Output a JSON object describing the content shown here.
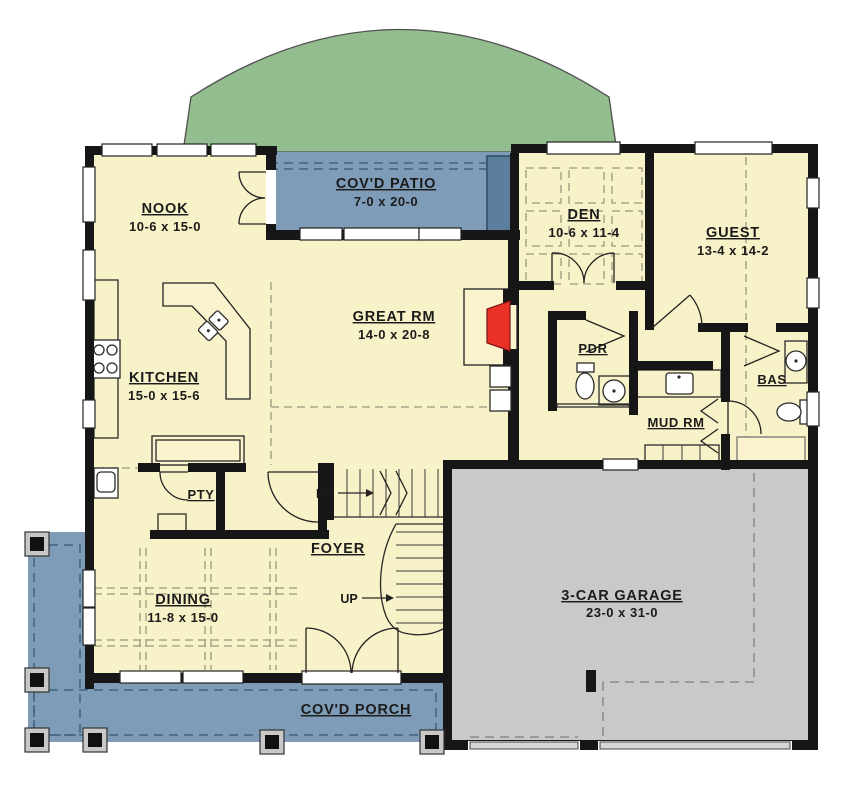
{
  "plan": {
    "rooms": {
      "nook": {
        "name": "NOOK",
        "dims": "10-6 x 15-0"
      },
      "patio": {
        "name": "COV'D PATIO",
        "dims": "7-0 x 20-0"
      },
      "den": {
        "name": "DEN",
        "dims": "10-6 x 11-4"
      },
      "guest": {
        "name": "GUEST",
        "dims": "13-4 x 14-2"
      },
      "great": {
        "name": "GREAT RM",
        "dims": "14-0 x 20-8"
      },
      "kitchen": {
        "name": "KITCHEN",
        "dims": "15-0 x 15-6"
      },
      "pdr": {
        "name": "PDR"
      },
      "bath": {
        "name": "BAS"
      },
      "mud": {
        "name": "MUD RM"
      },
      "pantry": {
        "name": "PTY"
      },
      "foyer": {
        "name": "FOYER"
      },
      "dining": {
        "name": "DINING",
        "dims": "11-8 x 15-0"
      },
      "garage": {
        "name": "3-CAR GARAGE",
        "dims": "23-0 x 31-0"
      },
      "porch": {
        "name": "COV'D PORCH"
      }
    },
    "stairs": {
      "down": "DN",
      "up": "UP"
    },
    "colors": {
      "floor": "#f8f2c8",
      "patio_blue": "#7e9cb8",
      "patio_dark": "#5b7f9d",
      "garage_gray": "#c9c9c9",
      "lawn_green": "#93bc8f",
      "wall_black": "#161616",
      "fireplace_red": "#e93128"
    }
  }
}
